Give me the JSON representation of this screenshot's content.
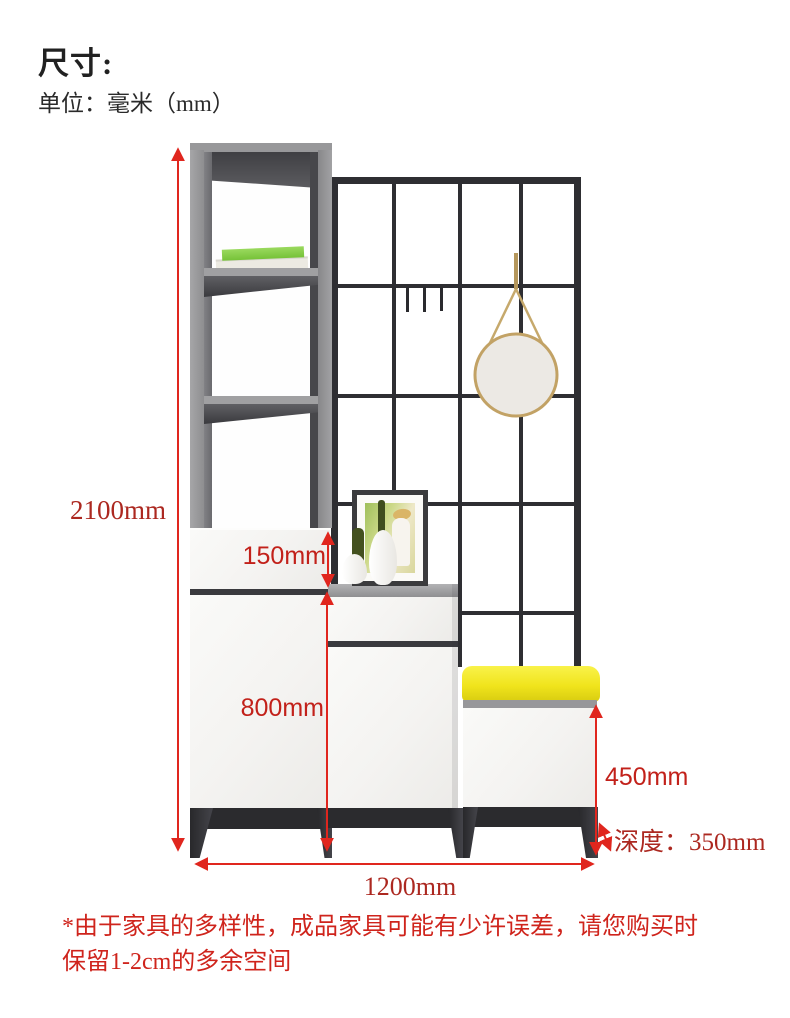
{
  "header": {
    "title": "尺寸:",
    "subtitle": "单位：毫米（mm）"
  },
  "dimensions": {
    "total_height": "2100mm",
    "drawer_height": "150mm",
    "lower_cabinet_height": "800mm",
    "bench_height": "450mm",
    "depth": "深度：350mm",
    "total_width": "1200mm"
  },
  "footnote": {
    "line1": "*由于家具的多样性，成品家具可能有少许误差，请您购买时",
    "line2": "保留1-2cm的多余空间"
  },
  "colors": {
    "heading_text": "#212121",
    "dimension_label_serif_red": "#ac2820",
    "dimension_label_sans_red": "#c2211a",
    "dimension_arrow_red": "#e0261e",
    "footnote_red": "#cf241c",
    "cabinet_gray": "#949496",
    "cabinet_interior_dark": "#4a4a4e",
    "grid_black": "#2e2e32",
    "panel_white": "#f6f5f3",
    "cushion_yellow": "#f0e41c",
    "mirror_face": "#ece9e4",
    "mirror_gold": "#c2a265",
    "book_green": "#86cc4a"
  }
}
